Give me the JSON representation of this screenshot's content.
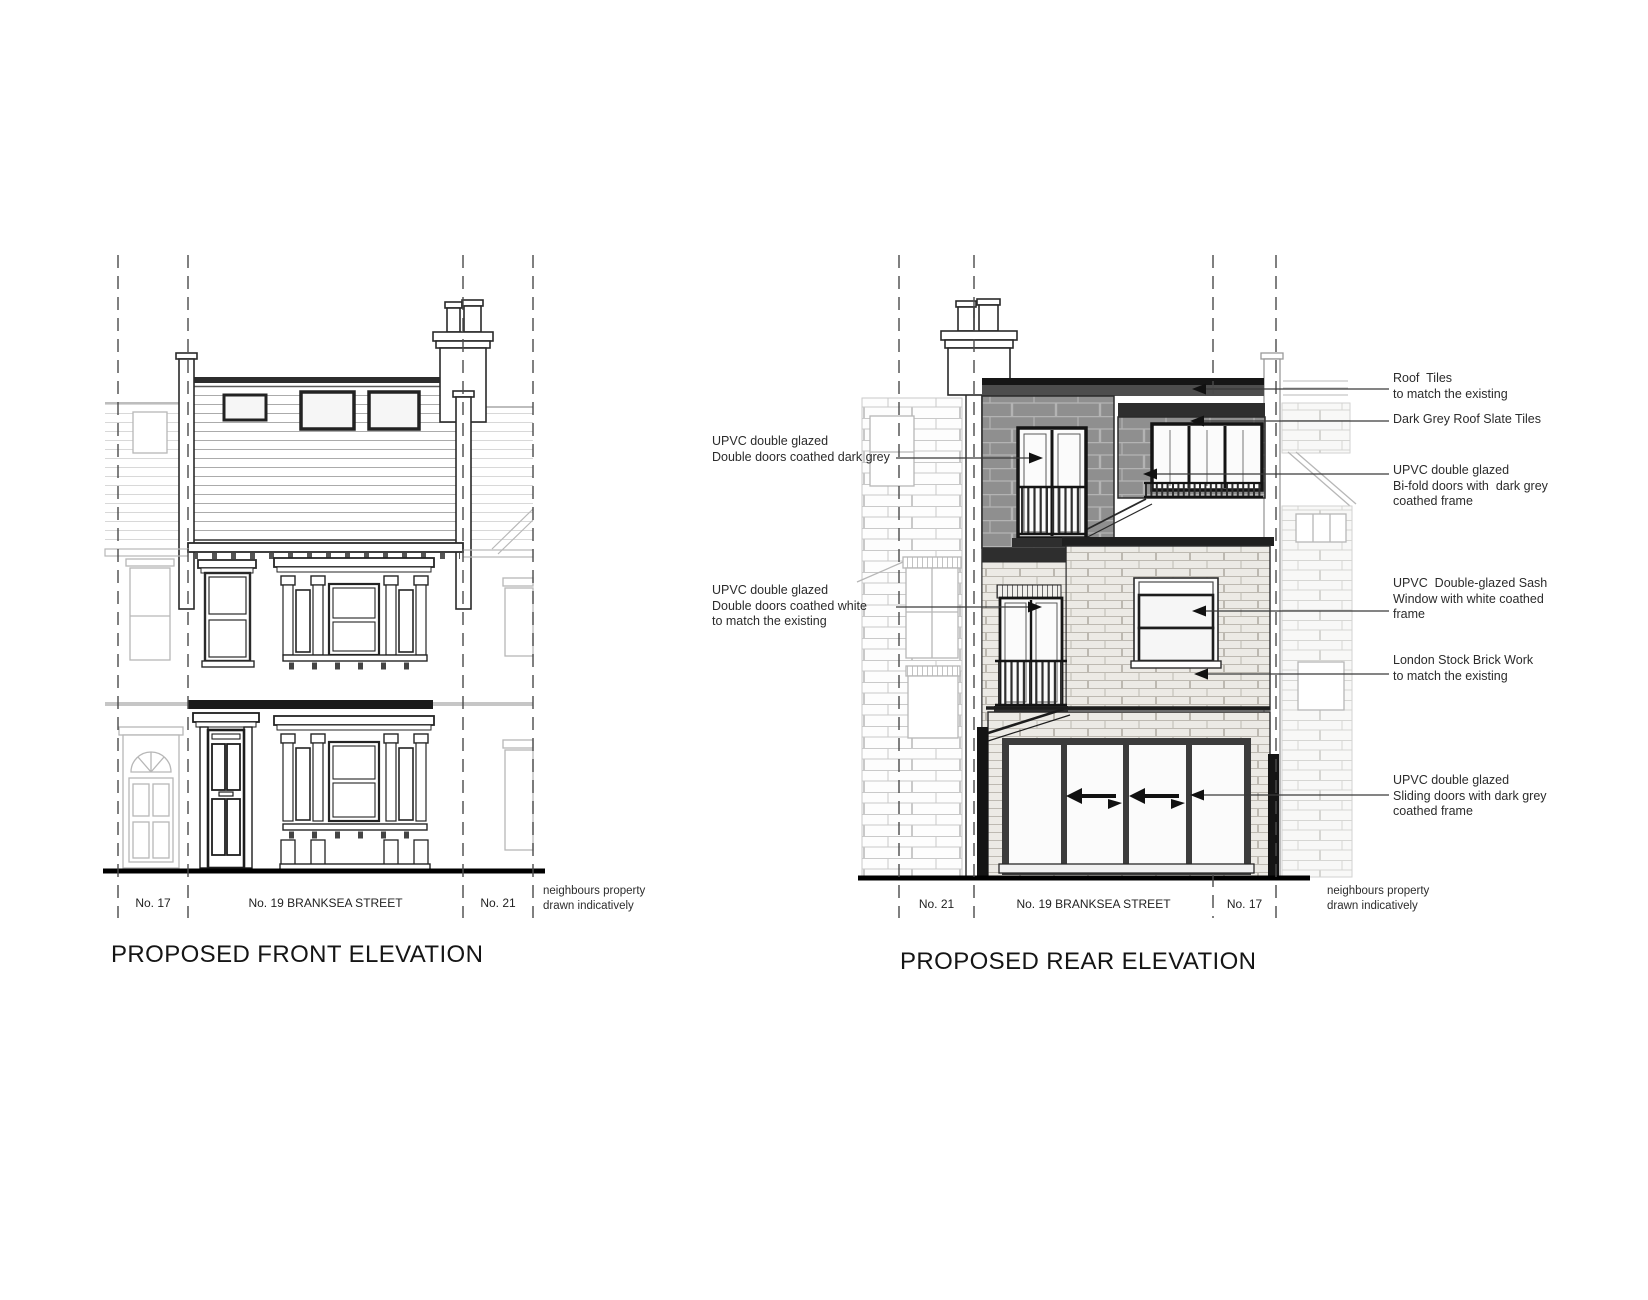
{
  "drawing": {
    "front": {
      "title": "PROPOSED FRONT ELEVATION",
      "plots": [
        "No. 17",
        "No. 19 BRANKSEA STREET",
        "No. 21"
      ],
      "note": "neighbours property\ndrawn indicatively"
    },
    "rear": {
      "title": "PROPOSED REAR ELEVATION",
      "plots": [
        "No. 21",
        "No. 19 BRANKSEA STREET",
        "No. 17"
      ],
      "note": "neighbours property\ndrawn indicatively",
      "labels_left": [
        "UPVC double glazed\nDouble doors coathed dark grey",
        "UPVC double glazed\nDouble doors coathed white\nto match the existing"
      ],
      "labels_right": [
        "Roof  Tiles\nto match the existing",
        "Dark Grey Roof Slate Tiles",
        "UPVC double glazed\nBi-fold doors with  dark grey\ncoathed frame",
        "UPVC  Double-glazed Sash\nWindow with white coathed\nframe",
        "London Stock Brick Work\nto match the existing",
        "UPVC double glazed\nSliding doors with dark grey\ncoathed frame"
      ]
    }
  }
}
